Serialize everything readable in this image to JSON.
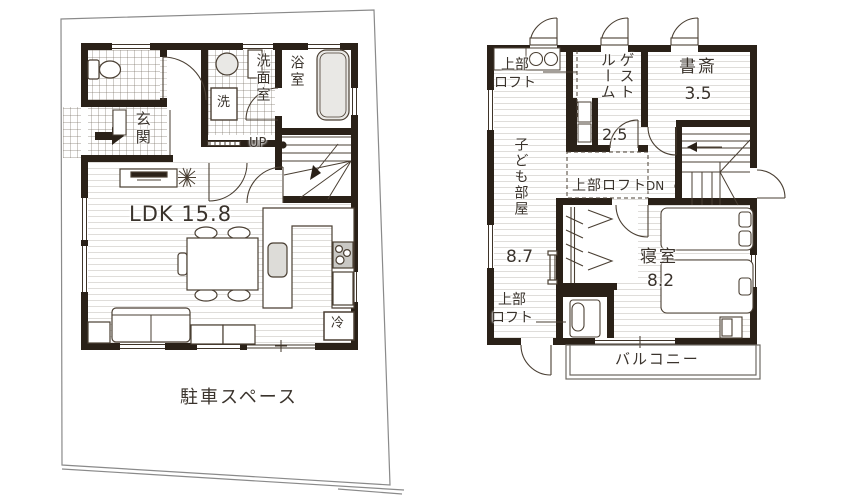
{
  "f1": {
    "genkan": "玄関",
    "laundry": "洗",
    "senmenshitsu": "洗面室",
    "yokushitsu": "浴室",
    "up": "UP",
    "ldk": "LDK 15.8",
    "fridge": "冷",
    "parking": "駐車スペース"
  },
  "f2": {
    "loft_top": "上部\nロフト",
    "guest": "ゲスト\nルーム",
    "guest_size": "2.5",
    "study": "書斎",
    "study_size": "3.5",
    "kids": "子ども部屋",
    "kids_size": "8.7",
    "loft_mid": "上部ロフト",
    "dn": "DN",
    "bedroom": "寝室",
    "bedroom_size": "8.2",
    "loft_bottom": "上部\nロフト",
    "balcony": "バルコニー"
  }
}
